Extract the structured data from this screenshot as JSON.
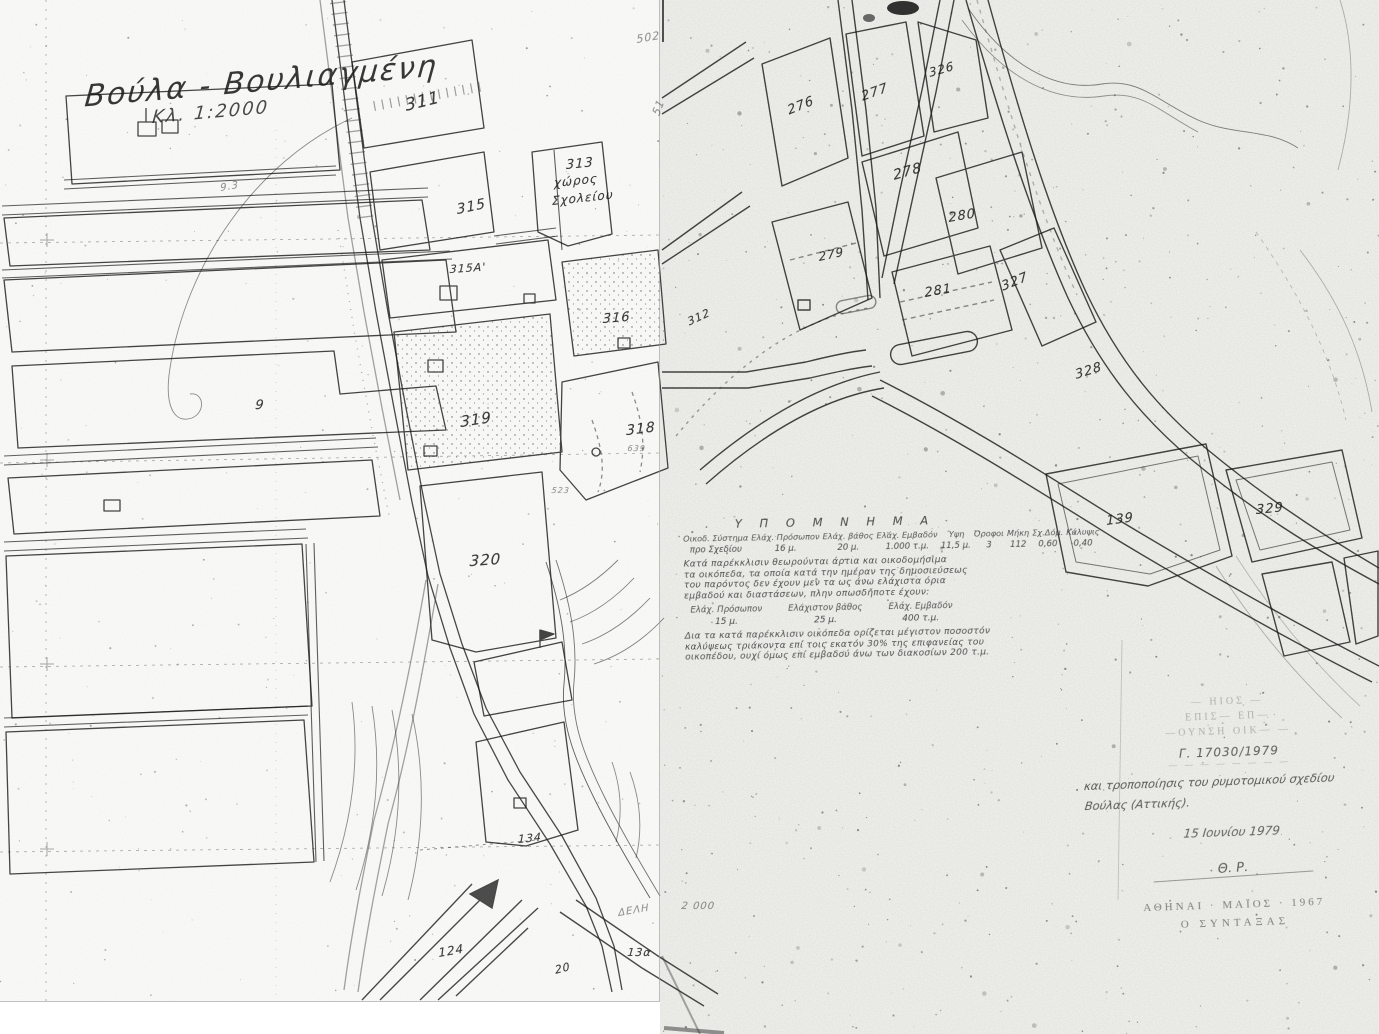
{
  "map": {
    "title": "Βούλα - Βουλιαγμένη",
    "scale_label": "Κλ. 1:2000"
  },
  "legend": {
    "heading": "Υ Π Ο Μ Ν Η Μ Α",
    "table_cols": [
      {
        "h": "Οικοδ. Σύστημα",
        "v": "προ Σχεδίου"
      },
      {
        "h": "Ελάχ. Πρόσωπον",
        "v": "16 μ."
      },
      {
        "h": "Ελάχ. βάθος",
        "v": "20 μ."
      },
      {
        "h": "Ελάχ. Εμβαδόν",
        "v": "1.000 τ.μ."
      },
      {
        "h": "Ύψη",
        "v": "11,5 μ."
      },
      {
        "h": "Όροφοι",
        "v": "3"
      },
      {
        "h": "Μήκη",
        "v": "112"
      },
      {
        "h": "Σχ.Δόμ.",
        "v": "0,60"
      },
      {
        "h": "Κάλυψις",
        "v": "0,40"
      }
    ],
    "paragraph1": [
      "Κατά παρέκκλισιν θεωρούνται άρτια και οικοδομήσιμα",
      "τα οικόπεδα, τα οποία κατά την ημέραν της δημοσιεύσεως",
      "του παρόντος δεν έχουν μεν τα ως άνω ελάχιστα όρια",
      "εμβαδού και διαστάσεων, πλην οπωσδήποτε έχουν:"
    ],
    "exception_cols": [
      {
        "h": "Ελάχ. Πρόσωπον",
        "v": "15 μ."
      },
      {
        "h": "Ελάχιστον βάθος",
        "v": "25 μ."
      },
      {
        "h": "Ελάχ. Εμβαδόν",
        "v": "400 τ.μ."
      }
    ],
    "paragraph2": [
      "Δια τα κατά παρέκκλισιν οικόπεδα ορίζεται μέγιστον ποσοστόν",
      "καλύψεως τριάκοντα επί τοις εκατόν 30% της επιφανείας του",
      "οικοπέδου, ουχί όμως επί εμβαδού άνω των διακοσίων 200 τ.μ."
    ]
  },
  "stamp": {
    "faint_lines": [
      "— ΗΙΟΣ —",
      "ΕΠΙΣ— ΕΠ—",
      "—ΟΥΝΣΗ ΟΙΚ— —"
    ],
    "protocol": "Γ. 17030/1979",
    "illegible_line": "— — — — — — — —",
    "note_line1": "και τροποποίησις του ρυμοτομικού σχεδίου",
    "note_line2": "Βούλας (Αττικής).",
    "date": "15 Ιουνίου 1979",
    "signature": "Θ. Ρ.",
    "city_date": "ΑΘΗΝΑΙ · ΜΑΪΟΣ · 1967",
    "role": "Ο ΣΥΝΤΑΞΑΣ"
  },
  "block_labels": [
    {
      "t": "311",
      "x": 404,
      "y": 96,
      "r": -14,
      "s": 17
    },
    {
      "t": "502",
      "x": 636,
      "y": 33,
      "r": -10,
      "s": 11,
      "c": "faint"
    },
    {
      "t": "51",
      "x": 650,
      "y": 112,
      "r": -70,
      "s": 11,
      "c": "faint"
    },
    {
      "t": "313",
      "x": 566,
      "y": 158,
      "r": -6,
      "s": 13
    },
    {
      "t": "χώρος",
      "x": 554,
      "y": 176,
      "r": -6,
      "s": 12
    },
    {
      "t": "Σχολείου",
      "x": 552,
      "y": 194,
      "r": -6,
      "s": 12
    },
    {
      "t": "315",
      "x": 456,
      "y": 202,
      "r": -12,
      "s": 14
    },
    {
      "t": "315Α'",
      "x": 450,
      "y": 263,
      "r": -4,
      "s": 11
    },
    {
      "t": "316",
      "x": 603,
      "y": 312,
      "r": -5,
      "s": 13
    },
    {
      "t": "312",
      "x": 686,
      "y": 316,
      "r": -25,
      "s": 11
    },
    {
      "t": "319",
      "x": 460,
      "y": 413,
      "r": -9,
      "s": 15
    },
    {
      "t": "318",
      "x": 626,
      "y": 423,
      "r": -7,
      "s": 14
    },
    {
      "t": "639",
      "x": 628,
      "y": 444,
      "r": 0,
      "s": 8,
      "c": "faint"
    },
    {
      "t": "523",
      "x": 552,
      "y": 486,
      "r": 0,
      "s": 8,
      "c": "faint"
    },
    {
      "t": "320",
      "x": 470,
      "y": 552,
      "r": -4,
      "s": 15
    },
    {
      "t": "9",
      "x": 256,
      "y": 398,
      "r": 0,
      "s": 13
    },
    {
      "t": "9.3",
      "x": 220,
      "y": 183,
      "r": -10,
      "s": 10,
      "c": "faint"
    },
    {
      "t": "134",
      "x": 518,
      "y": 833,
      "r": -6,
      "s": 11
    },
    {
      "t": "124",
      "x": 438,
      "y": 946,
      "r": -10,
      "s": 12
    },
    {
      "t": "13α",
      "x": 628,
      "y": 946,
      "r": 0,
      "s": 11
    },
    {
      "t": "20",
      "x": 554,
      "y": 964,
      "r": -15,
      "s": 11
    },
    {
      "t": "ΔΕΛΗ",
      "x": 618,
      "y": 908,
      "r": -10,
      "s": 10,
      "c": "faint"
    },
    {
      "t": "2 000",
      "x": 682,
      "y": 901,
      "r": 0,
      "s": 10,
      "c": "faint"
    },
    {
      "t": "276",
      "x": 786,
      "y": 104,
      "r": -22,
      "s": 13
    },
    {
      "t": "277",
      "x": 860,
      "y": 90,
      "r": -20,
      "s": 13
    },
    {
      "t": "326",
      "x": 928,
      "y": 66,
      "r": -16,
      "s": 12
    },
    {
      "t": "278",
      "x": 892,
      "y": 168,
      "r": -16,
      "s": 14
    },
    {
      "t": "279",
      "x": 818,
      "y": 250,
      "r": -12,
      "s": 12
    },
    {
      "t": "280",
      "x": 948,
      "y": 211,
      "r": -10,
      "s": 13
    },
    {
      "t": "281",
      "x": 924,
      "y": 286,
      "r": -10,
      "s": 13
    },
    {
      "t": "327",
      "x": 1000,
      "y": 280,
      "r": -22,
      "s": 13
    },
    {
      "t": "328",
      "x": 1074,
      "y": 368,
      "r": -18,
      "s": 13
    },
    {
      "t": "139",
      "x": 1106,
      "y": 514,
      "r": -8,
      "s": 13
    },
    {
      "t": "329",
      "x": 1256,
      "y": 503,
      "r": -6,
      "s": 13
    }
  ],
  "ink": {
    "line": "#1d1d1b",
    "paper_left": "#fcfcfa",
    "paper_right": "#f4f4f0"
  }
}
